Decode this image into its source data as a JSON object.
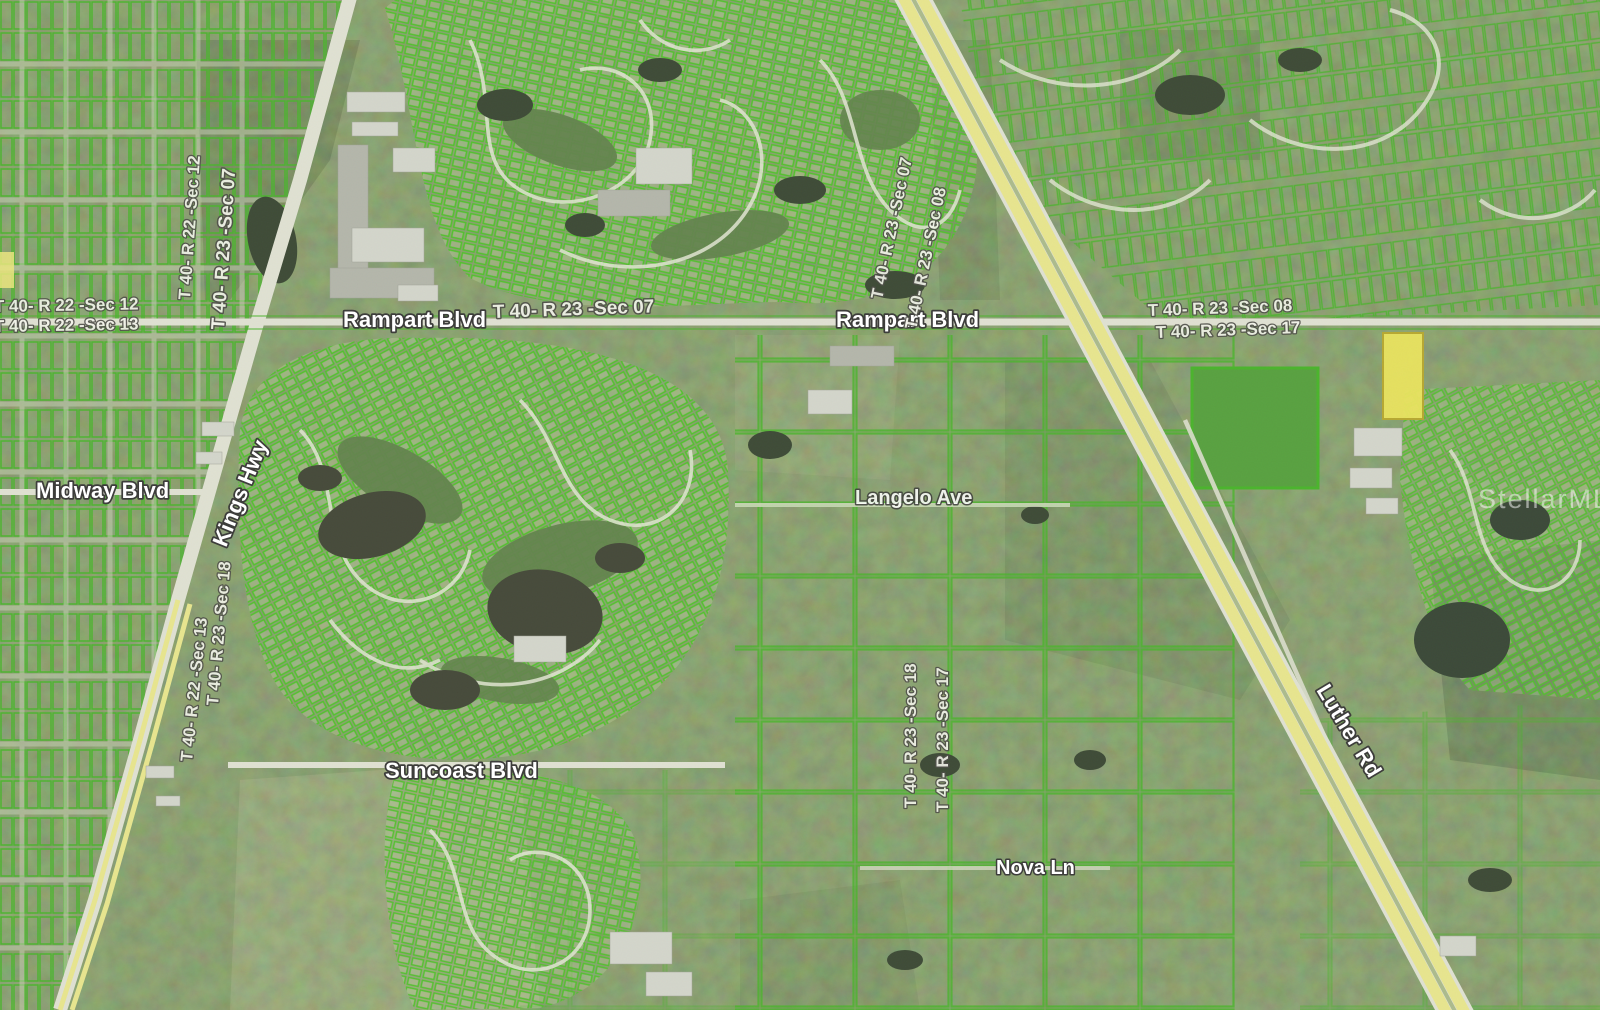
{
  "map": {
    "kind": "aerial-parcel-map",
    "labels": {
      "rampart_blvd_west": "Rampart Blvd",
      "rampart_blvd_east": "Rampart Blvd",
      "midway_blvd": "Midway Blvd",
      "kings_hwy": "Kings Hwy",
      "suncoast_blvd": "Suncoast Blvd",
      "langelo_ave": "Langelo Ave",
      "nova_ln": "Nova Ln",
      "luther_rd": "Luther Rd",
      "sec_left_edge_top": "T 40- R 22 -Sec 12",
      "sec_left_edge_bottom": "T 40- R 22 -Sec 13",
      "sec_kings_top_west": "T 40- R 22 -Sec 12",
      "sec_kings_top_east": "T 40- R 23 -Sec 07",
      "sec_rampart_mid": "T 40- R 23 -Sec 07",
      "sec_east_top": "T 40- R 23 -Sec 08",
      "sec_east_bottom": "T 40- R 23 -Sec 17",
      "sec_hwy_west": "T 40- R 23 -Sec 07",
      "sec_hwy_east": "T 40- R 23 -Sec 08",
      "sec_mid_west": "T 40- R 23 -Sec 18",
      "sec_mid_east": "T 40- R 23 -Sec 17",
      "sec_kings_mid_west": "T 40- R 22 -Sec 13",
      "sec_kings_mid_east": "T 40- R 23 -Sec 18",
      "watermark": "StellarMLS"
    },
    "colors": {
      "parcel_line_green": "#3db41c",
      "highway_yellow": "#f0ec8c",
      "road_pavement": "#e7e7d9",
      "highlighted_parcel_yellow": "#f2ea55",
      "water_dark": "#2f3c28",
      "field_green": "#4d9e33",
      "label_text": "#ffffff",
      "label_halo": "#3d3d3b"
    }
  }
}
